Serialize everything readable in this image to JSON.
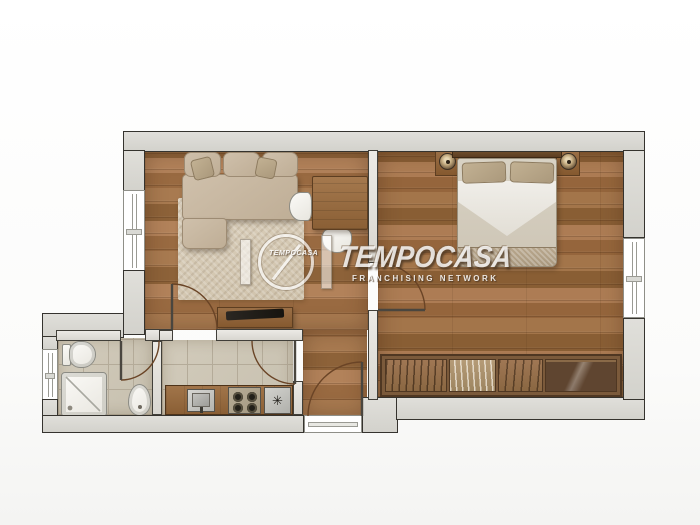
{
  "watermark": {
    "brand": "TEMPOCASA",
    "brand_small": "TEMPOCASA",
    "subtitle": "FRANCHISING NETWORK"
  },
  "kitchen": {
    "star_glyph": "✳"
  },
  "palette": {
    "wood_floor": "#a2714a",
    "wood_floor_dark": "#8d6239",
    "tile_floor": "#ccc5b4",
    "tile_grout": "#b4ab99",
    "wall_fill": "#d8d7d2",
    "wall_outline": "#35332e",
    "furniture_wood": "#8a6342",
    "fabric_beige": "#c6b6a0",
    "fixture_white": "#f4f3ef",
    "door_arc": "#6a4426"
  },
  "plan": {
    "rooms": [
      {
        "name": "living-room",
        "furniture": [
          "corner-sofa",
          "rug",
          "dining-table",
          "chairs",
          "tv-sideboard"
        ]
      },
      {
        "name": "bedroom",
        "furniture": [
          "double-bed",
          "nightstand-left",
          "nightstand-right",
          "wardrobe"
        ]
      },
      {
        "name": "bathroom",
        "furniture": [
          "toilet",
          "bidet",
          "shower"
        ]
      },
      {
        "name": "kitchen",
        "furniture": [
          "sink",
          "cooktop",
          "utility-basin"
        ]
      },
      {
        "name": "entry-hall",
        "furniture": []
      }
    ]
  }
}
